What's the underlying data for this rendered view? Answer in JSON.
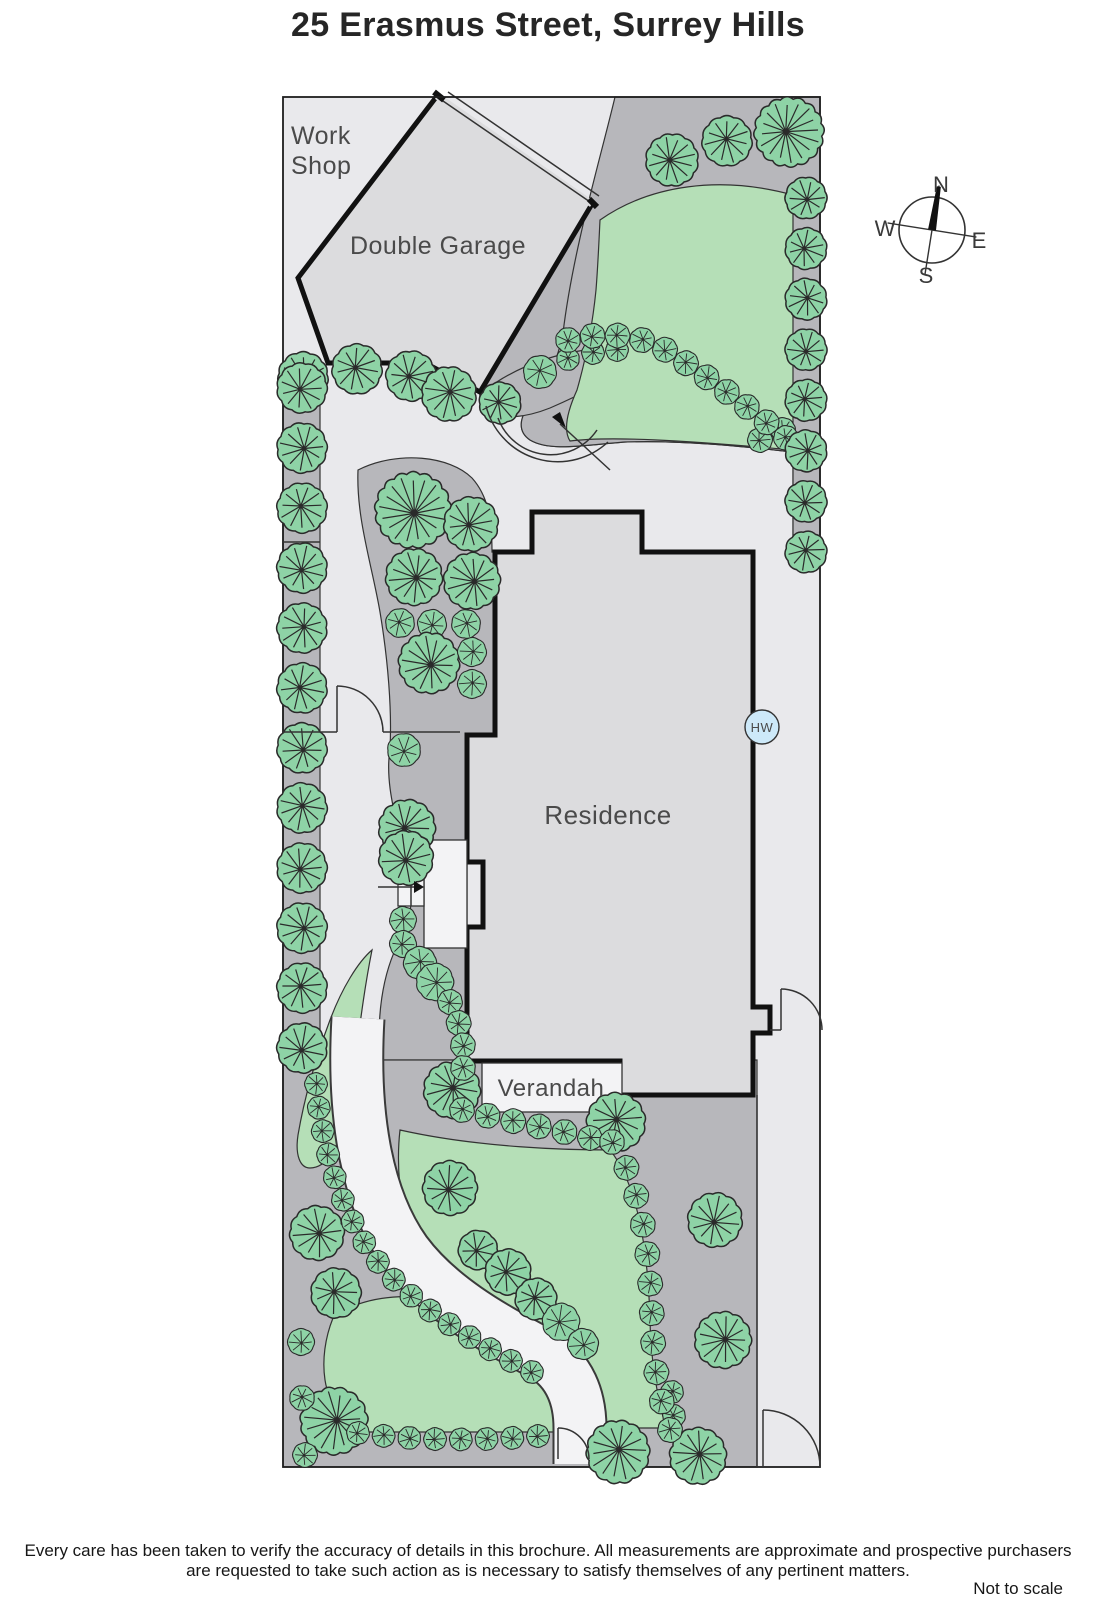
{
  "title": "25 Erasmus Street, Surrey Hills",
  "plan": {
    "labels": {
      "work_shop_line1": "Work",
      "work_shop_line2": "Shop",
      "double_garage": "Double Garage",
      "residence": "Residence",
      "verandah": "Verandah",
      "hot_water": "HW"
    }
  },
  "compass": {
    "north": "N",
    "south": "S",
    "east": "E",
    "west": "W"
  },
  "footer": {
    "disclaimer_line1": "Every care has been taken to verify the accuracy of details in this brochure.  All measurements are approximate and prospective purchasers",
    "disclaimer_line2": "are requested to take such action as is necessary to satisfy themselves of any pertinent matters.",
    "scale_note": "Not to scale"
  },
  "colors": {
    "site_bg": "#e9e9ec",
    "garden_bed": "#b7b7bb",
    "lawn": "#b5dfb7",
    "tree": "#8ed3a6",
    "building": "#dcdcde",
    "path": "#f3f3f5",
    "outline": "#333333",
    "label": "#4a4a4a",
    "hw_fill": "#cde9f9"
  }
}
